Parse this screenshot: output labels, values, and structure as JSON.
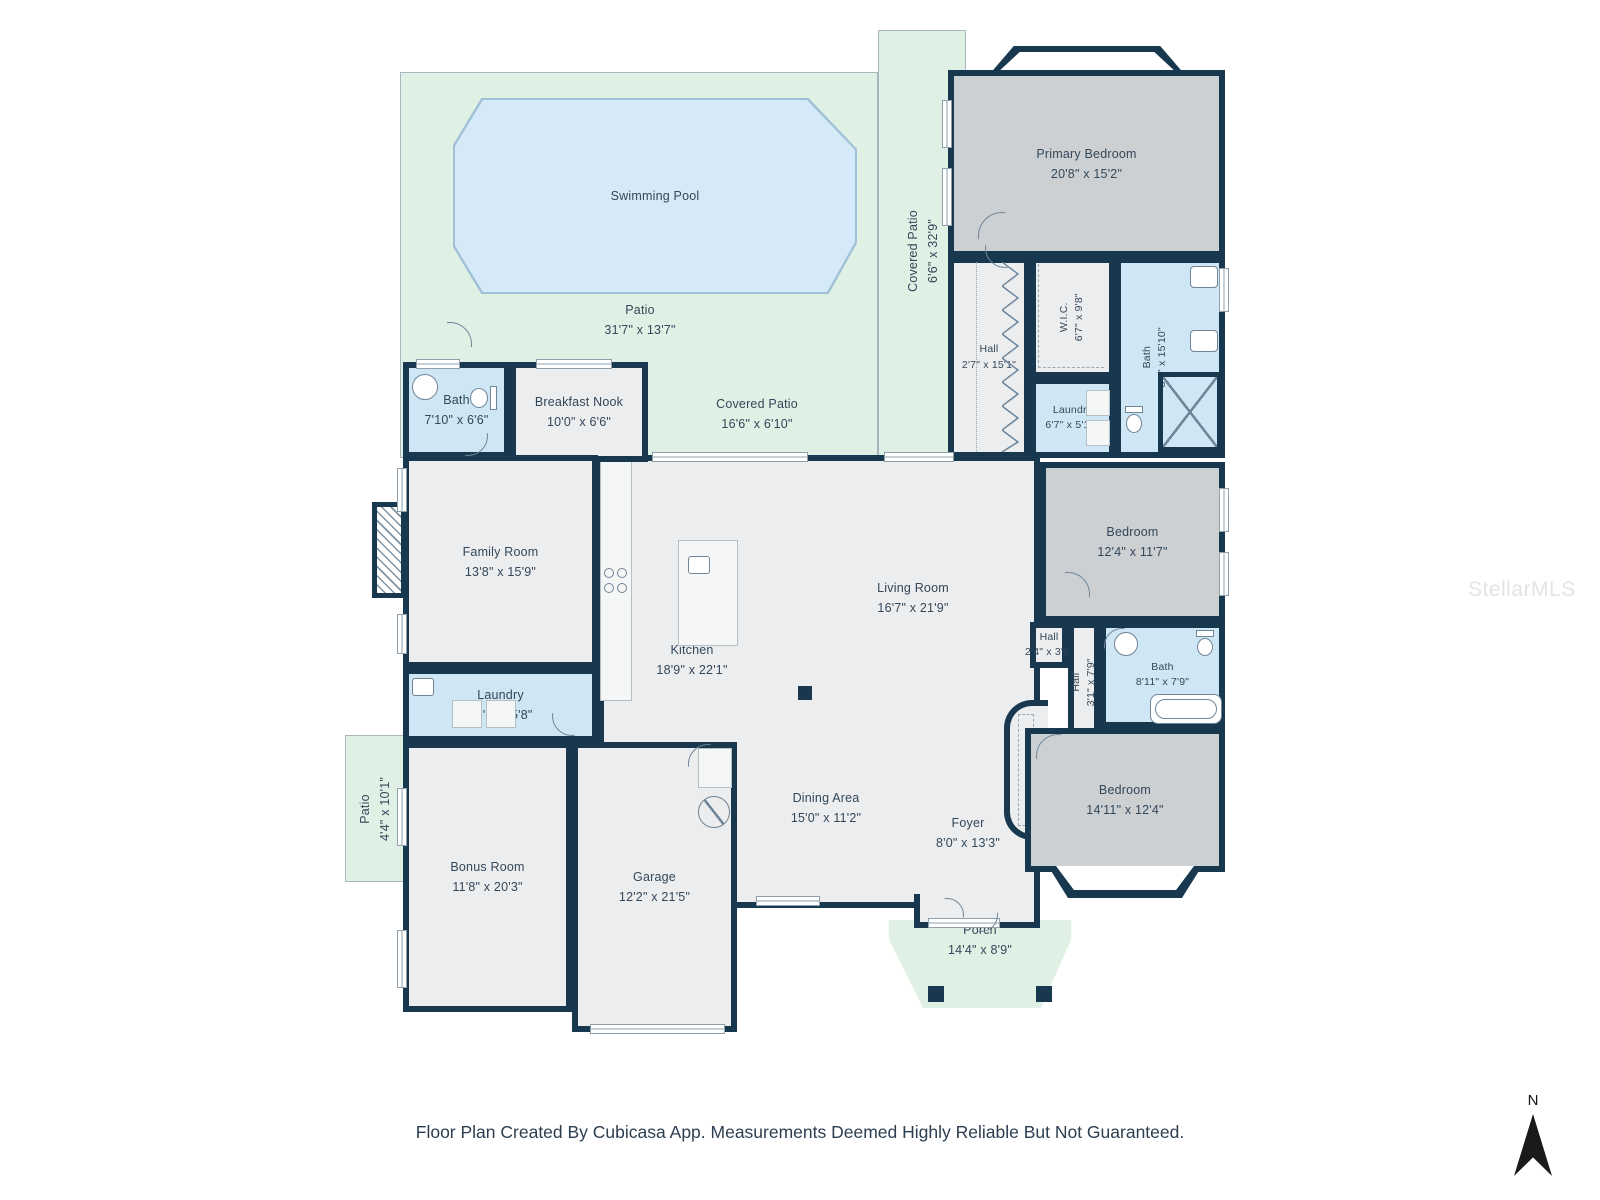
{
  "palette": {
    "wall": "#18384F",
    "floor": "#ECEDEE",
    "bedroom_floor": "#CDD0D2",
    "bath_floor": "#CFE6F4",
    "outdoor": "#DFF0E4",
    "pool": "#D6E9F8",
    "text": "#33475A"
  },
  "rooms": {
    "swimming_pool": {
      "name": "Swimming Pool",
      "dims": ""
    },
    "patio_main": {
      "name": "Patio",
      "dims": "31'7\" x 13'7\""
    },
    "covered_patio_side": {
      "name": "Covered Patio",
      "dims": "6'6\" x 32'9\""
    },
    "covered_patio_rear": {
      "name": "Covered Patio",
      "dims": "16'6\" x 6'10\""
    },
    "primary_bedroom": {
      "name": "Primary Bedroom",
      "dims": "20'8\" x 15'2\""
    },
    "hall_primary": {
      "name": "Hall",
      "dims": "2'7\" x 15'1\""
    },
    "wic": {
      "name": "W.I.C.",
      "dims": "6'7\" x 9'8\""
    },
    "bath_primary": {
      "name": "Bath",
      "dims": "8'0\" x 15'10\""
    },
    "laundry_primary": {
      "name": "Laundry",
      "dims": "6'7\" x 5'10\""
    },
    "bath_pool": {
      "name": "Bath",
      "dims": "7'10\" x 6'6\""
    },
    "breakfast_nook": {
      "name": "Breakfast Nook",
      "dims": "10'0\" x 6'6\""
    },
    "family_room": {
      "name": "Family Room",
      "dims": "13'8\" x 15'9\""
    },
    "kitchen": {
      "name": "Kitchen",
      "dims": "18'9\" x 22'1\""
    },
    "living_room": {
      "name": "Living Room",
      "dims": "16'7\" x 21'9\""
    },
    "laundry_main": {
      "name": "Laundry",
      "dims": "13'9\" x 5'8\""
    },
    "bedroom_mid": {
      "name": "Bedroom",
      "dims": "12'4\" x 11'7\""
    },
    "hall_small": {
      "name": "Hall",
      "dims": "2'4\" x 3'6\""
    },
    "hall_vertical": {
      "name": "Hall",
      "dims": "3'1\" x 7'9\""
    },
    "bath_hall": {
      "name": "Bath",
      "dims": "8'11\" x 7'9\""
    },
    "dining_area": {
      "name": "Dining Area",
      "dims": "15'0\" x 11'2\""
    },
    "foyer": {
      "name": "Foyer",
      "dims": "8'0\" x 13'3\""
    },
    "bedroom_rear": {
      "name": "Bedroom",
      "dims": "14'11\" x 12'4\""
    },
    "bonus_room": {
      "name": "Bonus Room",
      "dims": "11'8\" x 20'3\""
    },
    "garage": {
      "name": "Garage",
      "dims": "12'2\" x 21'5\""
    },
    "patio_side": {
      "name": "Patio",
      "dims": "4'4\" x 10'1\""
    },
    "porch": {
      "name": "Porch",
      "dims": "14'4\" x 8'9\""
    }
  },
  "compass_label": "N",
  "watermark": "StellarMLS",
  "footer": "Floor Plan Created By Cubicasa App. Measurements Deemed Highly Reliable But Not Guaranteed."
}
